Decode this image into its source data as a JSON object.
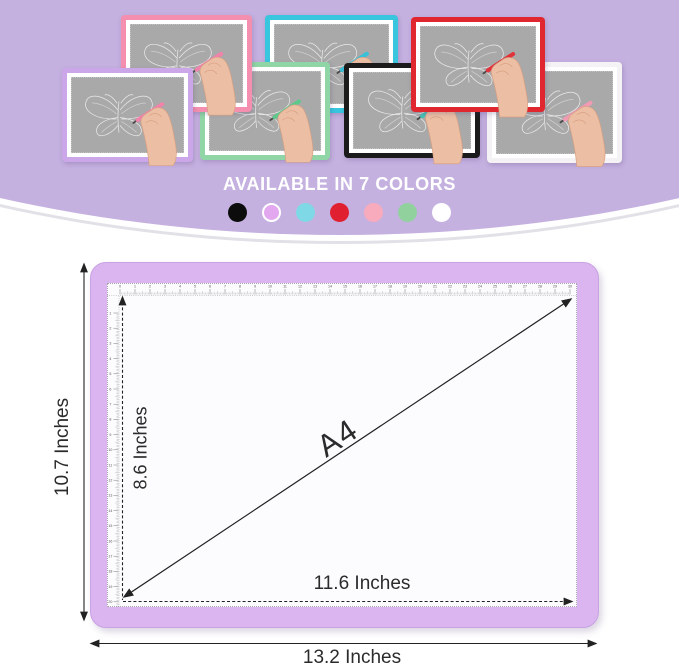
{
  "header": {
    "title": "AVAILABLE IN 7 COLORS",
    "title_color": "#ffffff",
    "background_color": "#c5b1e0",
    "rim_white": "#ffffff",
    "rim_gray": "#e3e1e8",
    "screen_color": "#a9a9a9",
    "pads": [
      {
        "name": "purple",
        "frame": "#cba6e8",
        "pen": "#f082ab"
      },
      {
        "name": "pink",
        "frame": "#f48fb0",
        "pen": "#f082ab"
      },
      {
        "name": "green",
        "frame": "#90d5a6",
        "pen": "#5cc98a"
      },
      {
        "name": "cyan",
        "frame": "#38c5de",
        "pen": "#38c0d8"
      },
      {
        "name": "black",
        "frame": "#1b1b1b",
        "pen": "#45c2b5"
      },
      {
        "name": "red",
        "frame": "#e02730",
        "pen": "#e0333c"
      },
      {
        "name": "white",
        "frame": "#f4f2f4",
        "pen": "#f29ab4"
      }
    ],
    "swatches": [
      {
        "name": "black",
        "color": "#0c0c0c"
      },
      {
        "name": "violet",
        "color": "#e2a7ee",
        "ring": "#ffffff"
      },
      {
        "name": "blue",
        "color": "#7fd8e5"
      },
      {
        "name": "red",
        "color": "#e02030"
      },
      {
        "name": "pink",
        "color": "#f7abbd"
      },
      {
        "name": "green",
        "color": "#90d19e"
      },
      {
        "name": "white",
        "color": "#ffffff"
      }
    ]
  },
  "diagram": {
    "pad_color": "#dab5f0",
    "pad_border": "#c9a2e3",
    "labels": {
      "outer_height": "10.7 Inches",
      "inner_height": "8.6 Inches",
      "diagonal": "A4",
      "inner_width": "11.6 Inches",
      "outer_width": "13.2 Inches"
    },
    "ruler": {
      "top_start": 0,
      "top_end": 30,
      "top_step_px": 15.0,
      "top_offset_px": 13,
      "left_start": 1,
      "left_end": 20,
      "left_step_px": 15.2,
      "left_offset_px": 17
    }
  }
}
